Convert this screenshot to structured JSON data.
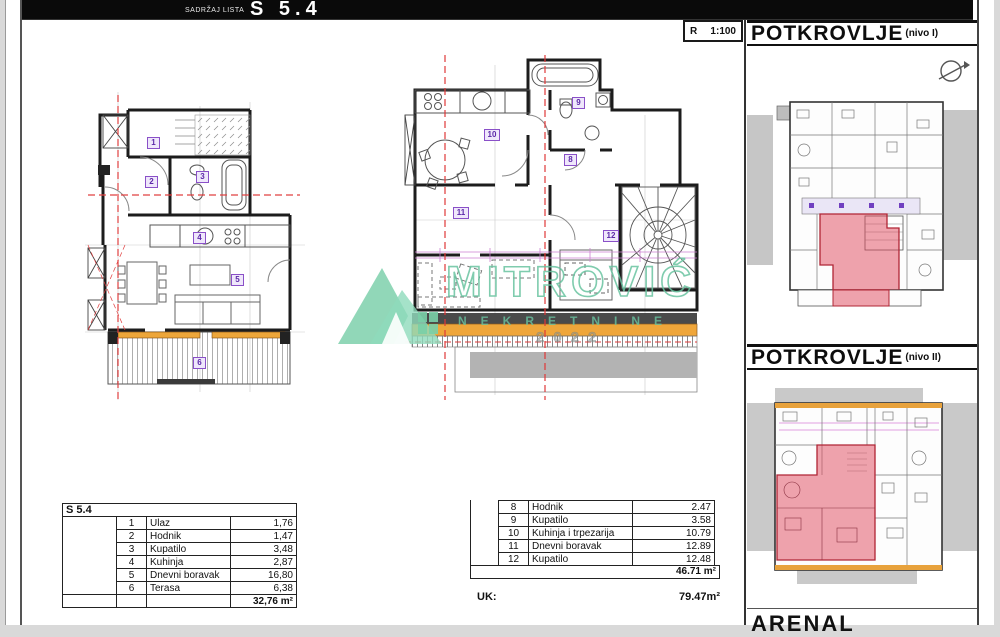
{
  "header": {
    "subtitle": "SADRŽAJ LISTA",
    "title": "S 5.4"
  },
  "scale": {
    "r": "R",
    "value": "1:100"
  },
  "side_panel": {
    "level1": {
      "title": "POTKROVLJE",
      "suffix": "(nivo I)"
    },
    "level2": {
      "title": "POTKROVLJE",
      "suffix": "(nivo II)"
    },
    "footer_text": "ARENAL"
  },
  "watermark": {
    "name": "MITROVIĆ",
    "subtitle": "NEKRETNINE",
    "year": "2022"
  },
  "tables": {
    "left": {
      "header": "S 5.4",
      "rows": [
        {
          "num": "1",
          "name": "Ulaz",
          "value": "1,76"
        },
        {
          "num": "2",
          "name": "Hodnik",
          "value": "1,47"
        },
        {
          "num": "3",
          "name": "Kupatilo",
          "value": "3,48"
        },
        {
          "num": "4",
          "name": "Kuhinja",
          "value": "2,87"
        },
        {
          "num": "5",
          "name": "Dnevni boravak",
          "value": "16,80"
        },
        {
          "num": "6",
          "name": "Terasa",
          "value": "6,38"
        }
      ],
      "total": "32,76 m²"
    },
    "right": {
      "rows": [
        {
          "num": "8",
          "name": "Hodnik",
          "value": "2.47"
        },
        {
          "num": "9",
          "name": "Kupatilo",
          "value": "3.58"
        },
        {
          "num": "10",
          "name": "Kuhinja i trpezarija",
          "value": "10.79"
        },
        {
          "num": "11",
          "name": "Dnevni boravak",
          "value": "12.89"
        },
        {
          "num": "12",
          "name": "Kupatilo",
          "value": "12.48"
        }
      ],
      "total": "46.71 m²"
    }
  },
  "summary": {
    "label": "UK:",
    "value": "79.47m²"
  },
  "icons": {
    "north_arrow": "circle-with-slash-arrow"
  },
  "colors": {
    "highlight_red": "#d94f63",
    "roof_orange": "#eda63a",
    "watermark_green": "#74cfa8",
    "label_purple": "#7a3fc0",
    "titlebar_black": "#0a0a0a"
  }
}
